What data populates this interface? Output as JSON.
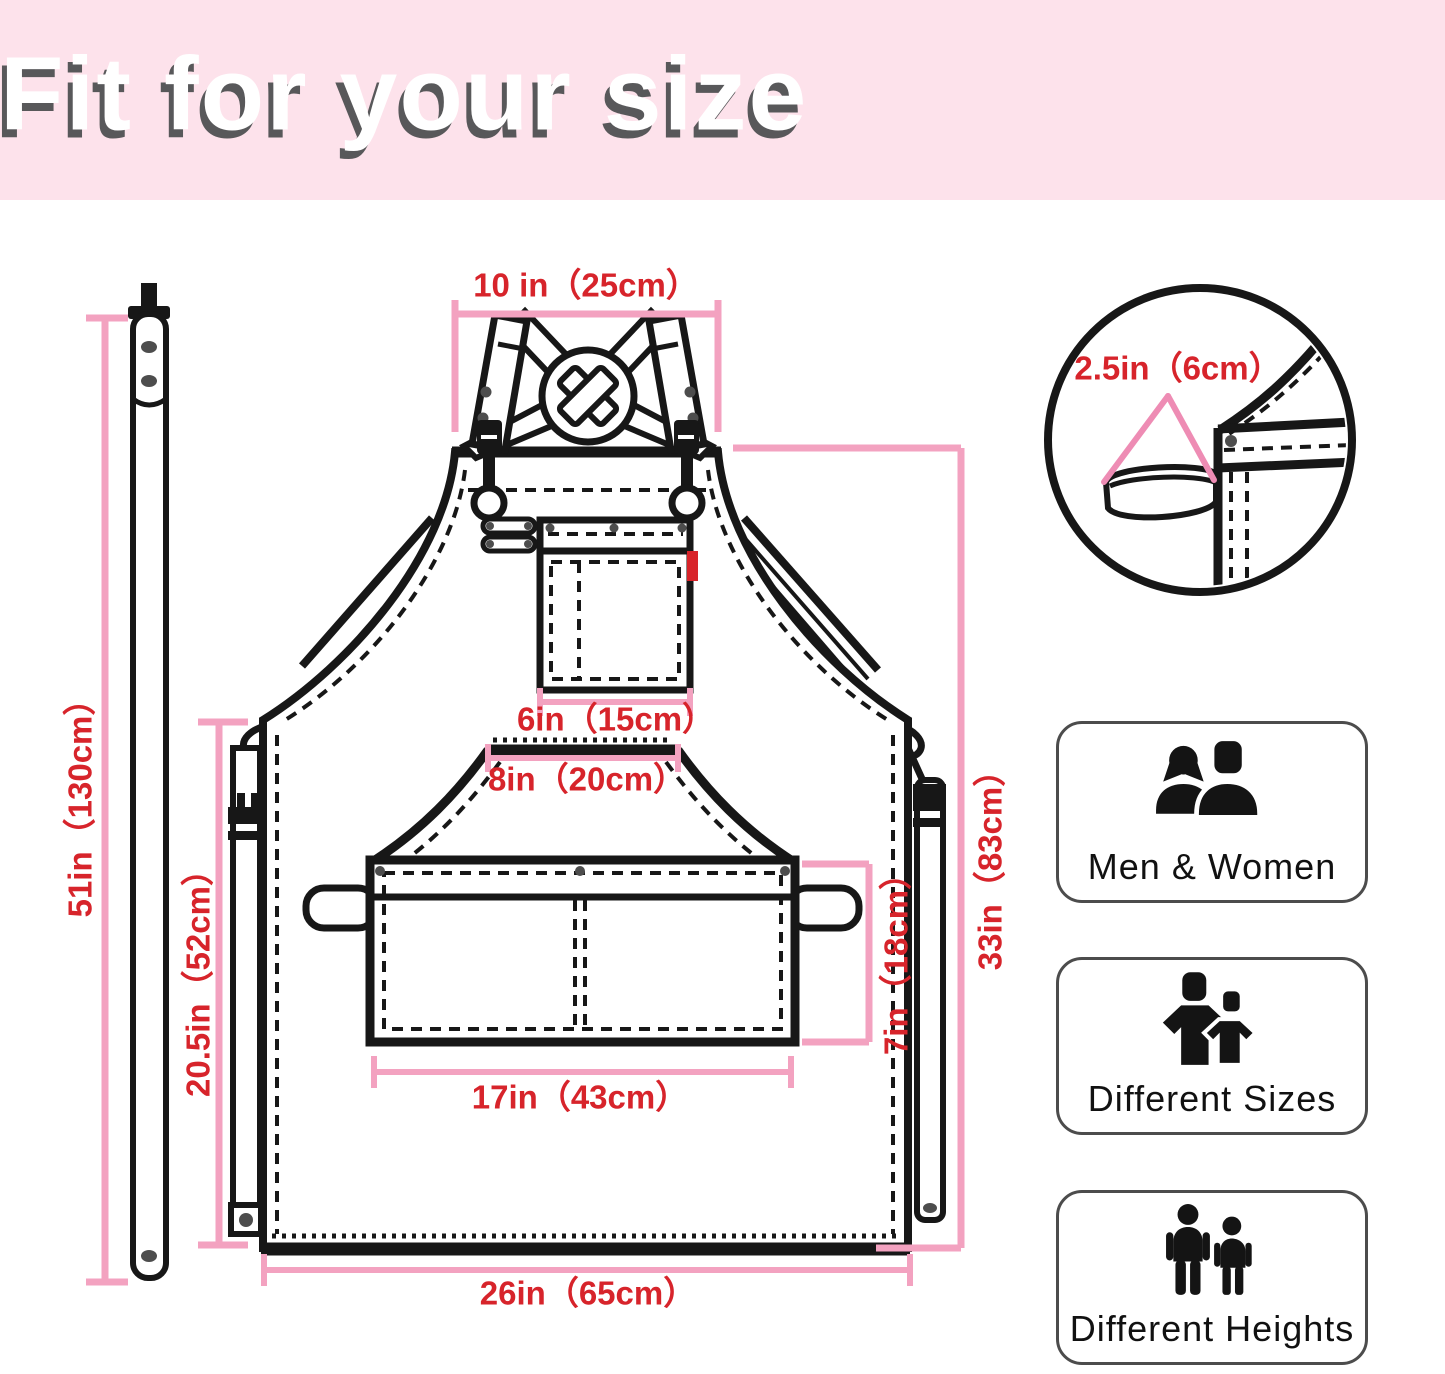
{
  "title": "Fit for your size",
  "colors": {
    "banner_pink": "#FDE2EB",
    "dimension_pink": "#F3A2C0",
    "measurement_red": "#D7242B",
    "line_black": "#171717"
  },
  "measurements": {
    "neck_width": "10 in（25cm）",
    "towel_loop": "2.5in（6cm）",
    "chest_pocket_width": "6in（15cm）",
    "waist_pocket_opening": "8in（20cm）",
    "front_pocket_height": "7in（18cm）",
    "front_pocket_width": "17in（43cm）",
    "apron_length": "33in（83cm）",
    "side_strap_length": "20.5in（52cm）",
    "waist_strap_length": "51in（130cm）",
    "bottom_width": "26in（65cm）"
  },
  "features": [
    {
      "icon": "men-women-icon",
      "label": "Men & Women"
    },
    {
      "icon": "different-sizes-icon",
      "label": "Different Sizes"
    },
    {
      "icon": "different-heights-icon",
      "label": "Different Heights"
    }
  ]
}
